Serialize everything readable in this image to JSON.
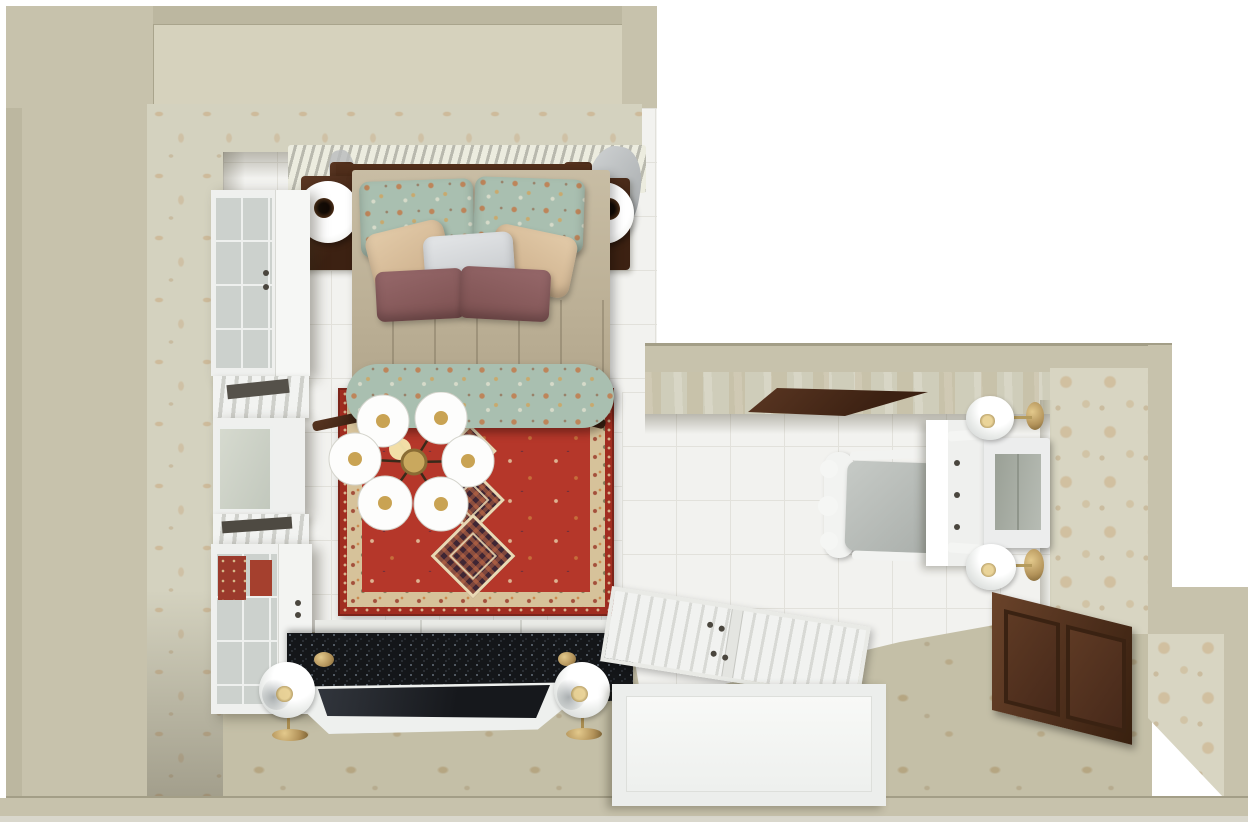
{
  "scene": {
    "kind": "top-down 3d interior render",
    "room": "bedroom with dressing annex",
    "visible_text": "none"
  },
  "palette": {
    "wall": "#c7c2ac",
    "wall_dark": "#bcb7a0",
    "wall_panel": "#d6d2bd",
    "wallpaper": "#d4d2bf",
    "damask": "#d8d5c2",
    "tile": "#f2f2ef",
    "tile_line": "#e2e1db",
    "carpet": "#c4bfa7",
    "rug_red": "#b5372a",
    "rug_red_deep": "#a12d20",
    "rug_cream": "#d6c29a",
    "rug_dark": "#3f2634",
    "bed": "#c0b49b",
    "floral": "#a9bfb0",
    "mauve": "#8c5e5e",
    "pillow_beige": "#d9be9e",
    "pillow_white": "#dadcde",
    "wood": "#5b3723",
    "wood_dark": "#3c2112",
    "brass": "#b3935a",
    "furniture_white": "#eff0ee",
    "tv_screen": "#1e2126",
    "mirror": "#a8ada0",
    "curtain": "#b9bcbd",
    "granite": "#141619"
  },
  "objects": [
    "outer-walls",
    "wallpaper-walls",
    "tile-floor",
    "patterned-carpet",
    "radiator",
    "headboard",
    "nightstand-left",
    "nightstand-right",
    "table-lamp-left",
    "table-lamp-right",
    "double-bed",
    "floral-pillow-left",
    "floral-pillow-right",
    "beige-pillow-left",
    "white-pillow",
    "beige-pillow-right",
    "mauve-pillow-left",
    "mauve-pillow-right",
    "bench-ottoman",
    "persian-rug",
    "ceiling-chandelier",
    "wardrobe-column-left",
    "granite-media-console",
    "television",
    "sphere-floor-lamp-left",
    "sphere-floor-lamp-right",
    "white-wardrobe-bottom",
    "vanity-chair",
    "vanity-table",
    "vanity-mirror",
    "wall-sconce-lamp-top",
    "wall-sconce-lamp-bottom",
    "wood-door-panel",
    "door-header-panel"
  ]
}
